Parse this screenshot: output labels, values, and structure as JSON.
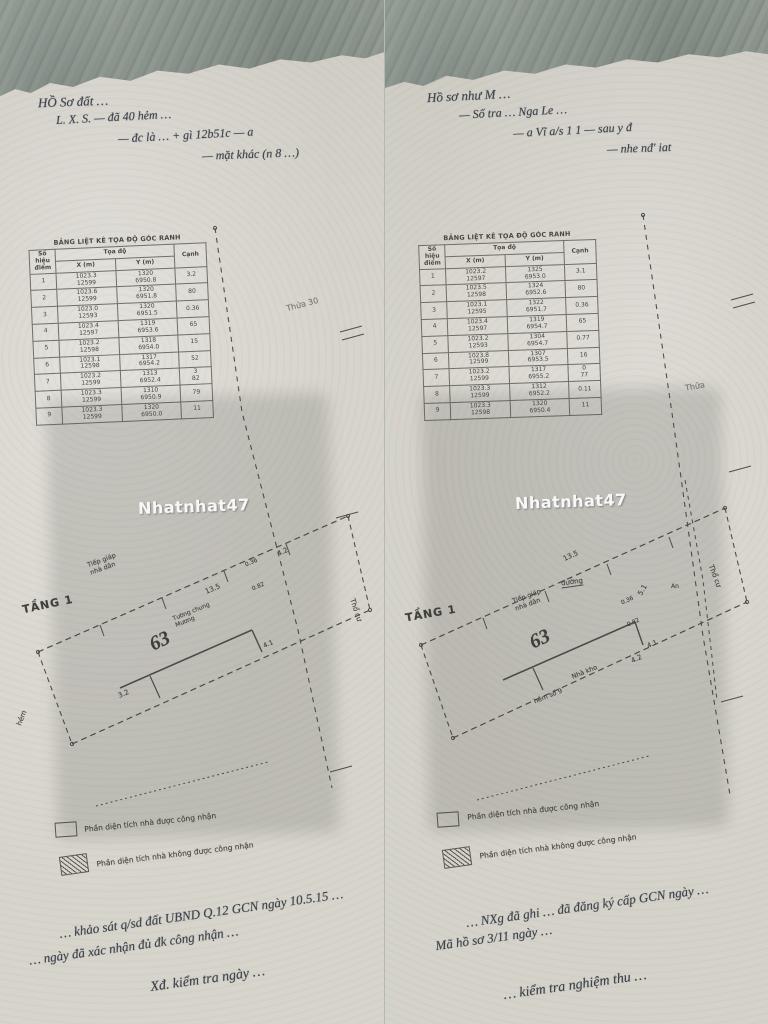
{
  "watermark": "Nhatnhat47",
  "colors": {
    "paper": "#d8d5cc",
    "fabric": "#98a29a",
    "ink": "#45443e",
    "handwriting": "#39404a"
  },
  "left": {
    "header_lines": [
      "HỒ Sơ đất …",
      "L. X. S. — đã 40 hẻm …",
      "— đc là … + gì 12b51c — a",
      "— mặt khác (n 8 …)"
    ],
    "table": {
      "title": "BẢNG LIỆT KÊ TỌA ĐỘ GÓC RANH",
      "col_point": "Số hiệu điểm",
      "col_coord": "Tọa độ",
      "col_x": "X (m)",
      "col_y": "Y (m)",
      "col_edge": "Cạnh",
      "rows": [
        {
          "n": "1",
          "x": "1023.3\n12599",
          "y": "1320\n6950.8",
          "c": "3.2"
        },
        {
          "n": "2",
          "x": "1023.6\n12599",
          "y": "1320\n6951.8",
          "c": "80"
        },
        {
          "n": "3",
          "x": "1023.0\n12593",
          "y": "1320\n6951.5",
          "c": "0.36"
        },
        {
          "n": "4",
          "x": "1023.4\n12597",
          "y": "1319\n6953.6",
          "c": "65"
        },
        {
          "n": "5",
          "x": "1023.2\n12598",
          "y": "1318\n6954.0",
          "c": "15"
        },
        {
          "n": "6",
          "x": "1023.1\n12598",
          "y": "1317\n6954.2",
          "c": "52"
        },
        {
          "n": "7",
          "x": "1023.2\n12599",
          "y": "1313\n6952.4",
          "c": "3\n82"
        },
        {
          "n": "8",
          "x": "1023.3\n12599",
          "y": "1310\n6950.9",
          "c": "79"
        },
        {
          "n": "9",
          "x": "1023.3\n12599",
          "y": "1320\n6950.0",
          "c": "11"
        }
      ]
    },
    "side_label": "Thửa 30",
    "plan": {
      "floor_label": "TẦNG 1",
      "lot_number": "63",
      "adj_label": "Tiếp giáp\nnhà dân",
      "wall_label": "Tường chung\nMương",
      "dim_a": "13.5",
      "dim_b": "4.2",
      "dim_c": "3.2",
      "dim_d": "0.36",
      "dim_e": "0.82",
      "dim_f": "4.1",
      "right_label": "Thổ cư",
      "street_label": "hẻm"
    },
    "legend": {
      "item1": "Phần diện tích nhà được công nhận",
      "item2": "Phần diện tích nhà không được công nhận"
    },
    "notes": [
      "… khảo sát q/sd đất UBND Q.12 GCN ngày 10.5.15 …",
      "… ngày đã xác nhận đủ đk công nhận …",
      "Xđ. kiểm tra ngày …"
    ]
  },
  "right": {
    "header_lines": [
      "Hồ sơ như M …",
      "— Số tra … Nga Le …",
      "— a Vĩ a/s 1 1 — sau y đ",
      "— nhe nđ' iat"
    ],
    "table": {
      "title": "BẢNG LIỆT KÊ TỌA ĐỘ GÓC RANH",
      "col_point": "Số hiệu điểm",
      "col_coord": "Tọa độ",
      "col_x": "X (m)",
      "col_y": "Y (m)",
      "col_edge": "Cạnh",
      "rows": [
        {
          "n": "1",
          "x": "1023.2\n12597",
          "y": "1325\n6953.0",
          "c": "3.1"
        },
        {
          "n": "2",
          "x": "1023.5\n12598",
          "y": "1324\n6952.6",
          "c": "80"
        },
        {
          "n": "3",
          "x": "1023.1\n12595",
          "y": "1322\n6951.7",
          "c": "0.36"
        },
        {
          "n": "4",
          "x": "1023.4\n12597",
          "y": "1319\n6954.7",
          "c": "65"
        },
        {
          "n": "5",
          "x": "1023.2\n12593",
          "y": "1304\n6954.7",
          "c": "0.77"
        },
        {
          "n": "6",
          "x": "1023.8\n12599",
          "y": "1307\n6953.5",
          "c": "16"
        },
        {
          "n": "7",
          "x": "1023.2\n12599",
          "y": "1317\n6955.2",
          "c": "0\n77"
        },
        {
          "n": "8",
          "x": "1023.3\n12599",
          "y": "1312\n6952.2",
          "c": "0.11"
        },
        {
          "n": "9",
          "x": "1023.3\n12598",
          "y": "1320\n6950.4",
          "c": "11"
        }
      ]
    },
    "side_label": "Thửa",
    "plan": {
      "floor_label": "TẦNG 1",
      "lot_number": "63",
      "adj_label": "Tiếp giáp\nnhà dân",
      "wall_label": "Nhà kho",
      "alley_label": "hẻm số 9",
      "dim_a": "13.5",
      "dim_b": "5.1",
      "dim_c": "4.2",
      "dim_d": "0.36",
      "dim_e": "0.82",
      "dim_f": "4.1",
      "right_label": "Thổ cư",
      "street_label": "đường",
      "small_label": "An"
    },
    "legend": {
      "item1": "Phần diện tích nhà được công nhận",
      "item2": "Phần diện tích nhà không được công nhận"
    },
    "notes": [
      "… NXg đã ghi … đã đăng ký cấp GCN ngày …",
      "Mã hồ sơ 3/11 ngày …",
      "… kiểm tra nghiệm thu …"
    ]
  }
}
